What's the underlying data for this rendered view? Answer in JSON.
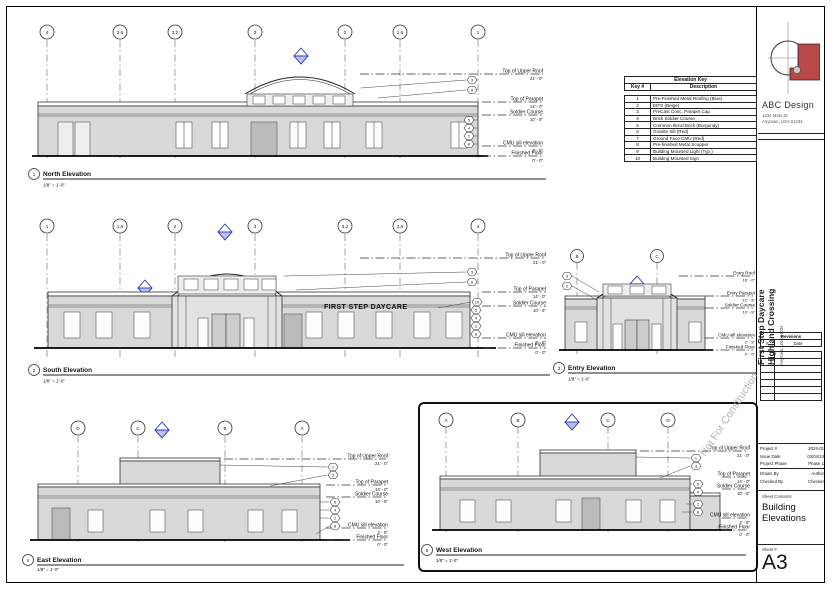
{
  "sheet": {
    "watermark": "Not For Construction",
    "firm": {
      "name": "ABC Design",
      "address1": "1234 Main St.",
      "address2": "Anytown, USA 01234"
    },
    "project": {
      "line1": "First Step Daycare",
      "line2": "Highland Crossing",
      "address": "Anytown, USA 01234"
    },
    "revisions": {
      "title": "Revisions",
      "col_no": "#",
      "col_date": "Date"
    },
    "info": {
      "project_label": "Project #",
      "project_value": "2024-01",
      "issue_label": "Issue Date",
      "issue_value": "03/04/24",
      "phase_label": "Project Phase",
      "phase_value": "Phase 1",
      "drawn_label": "Drawn By",
      "drawn_value": "Author",
      "checked_label": "Checked By",
      "checked_value": "Checker"
    },
    "contents_label": "Sheet Contents",
    "contents": "Building Elevations",
    "sheet_number_label": "Sheet #",
    "sheet_number": "A3"
  },
  "elevation_key": {
    "title": "Elevation Key",
    "col_key": "Key #",
    "col_desc": "Description",
    "rows": [
      {
        "key": "1",
        "desc": "Pre-Finished Metal Roofing (Blue)"
      },
      {
        "key": "2",
        "desc": "EIFS (Beige)"
      },
      {
        "key": "3",
        "desc": "PreCast Conc. Parapet Cap"
      },
      {
        "key": "4",
        "desc": "Brick Soldier Course"
      },
      {
        "key": "5",
        "desc": "Common Bond Brick (Burgundy)"
      },
      {
        "key": "6",
        "desc": "Granite Sill (Red)"
      },
      {
        "key": "7",
        "desc": "Ground Face CMU (Red)"
      },
      {
        "key": "8",
        "desc": "Pre-finished Metal Scupper"
      },
      {
        "key": "9",
        "desc": "Building Mounted Light (Typ.)"
      },
      {
        "key": "10",
        "desc": "Building Mounted Sign"
      }
    ]
  },
  "views": {
    "north": {
      "number": "1",
      "title": "North Elevation",
      "scale": "1/8\" = 1'-0\"",
      "grids": [
        "4",
        "3.6",
        "3.2",
        "3",
        "2",
        "1.6",
        "1"
      ],
      "levels": [
        {
          "name": "Top of Upper Roof",
          "value": "21' - 0\""
        },
        {
          "name": "Top of Parapet",
          "value": "14' - 0\""
        },
        {
          "name": "Soldier Course",
          "value": "10' - 8\""
        },
        {
          "name": "CMU sill elevation",
          "value": "2' - 8\""
        },
        {
          "name": "Finished Floor",
          "value": "0' - 0\""
        }
      ],
      "keynotes": [
        "3",
        "9",
        "5",
        "4",
        "2",
        "8"
      ]
    },
    "south": {
      "number": "2",
      "title": "South Elevation",
      "scale": "1/8\" = 1'-0\"",
      "sign": "FIRST STEP DAYCARE",
      "grids": [
        "1",
        "1.6",
        "2",
        "3",
        "3.2",
        "3.6",
        "4"
      ],
      "levels": [
        {
          "name": "Top of Upper Roof",
          "value": "21' - 0\""
        },
        {
          "name": "Top of Parapet",
          "value": "14' - 0\""
        },
        {
          "name": "Soldier Course",
          "value": "10' - 8\""
        },
        {
          "name": "CMU sill elevation",
          "value": "2' - 8\""
        },
        {
          "name": "Finished Floor",
          "value": "0' - 0\""
        }
      ],
      "keynotes": [
        "3",
        "9",
        "10",
        "5",
        "4",
        "2",
        "8"
      ]
    },
    "entry": {
      "number": "3",
      "title": "Entry Elevation",
      "scale": "1/8\" = 1'-0\"",
      "grids": [
        "B",
        "C"
      ],
      "levels": [
        {
          "name": "Entry Roof",
          "value": "16' - 0\""
        },
        {
          "name": "Entry Parapet",
          "value": "12' - 8\""
        },
        {
          "name": "Soldier Course",
          "value": "10' - 8\""
        },
        {
          "name": "CMU sill elevation",
          "value": "2' - 8\""
        },
        {
          "name": "Finished Floor",
          "value": "0' - 0\""
        }
      ],
      "keynotes": [
        "3",
        "2"
      ]
    },
    "east": {
      "number": "4",
      "title": "East Elevation",
      "scale": "1/8\" = 1'-0\"",
      "grids": [
        "D",
        "C",
        "B",
        "A"
      ],
      "levels": [
        {
          "name": "Top of Upper Roof",
          "value": "21' - 0\""
        },
        {
          "name": "Top of Parapet",
          "value": "14' - 0\""
        },
        {
          "name": "Soldier Course",
          "value": "10' - 8\""
        },
        {
          "name": "CMU sill elevation",
          "value": "2' - 8\""
        },
        {
          "name": "Finished Floor",
          "value": "0' - 0\""
        }
      ],
      "keynotes": [
        "1",
        "3",
        "5",
        "4",
        "2",
        "8"
      ]
    },
    "west": {
      "number": "5",
      "title": "West Elevation",
      "scale": "1/8\" = 1'-0\"",
      "grids": [
        "A",
        "B",
        "C",
        "D"
      ],
      "levels": [
        {
          "name": "Top of Upper Roof",
          "value": "21' - 0\""
        },
        {
          "name": "Top of Parapet",
          "value": "14' - 0\""
        },
        {
          "name": "Soldier Course",
          "value": "10' - 8\""
        },
        {
          "name": "CMU sill elevation",
          "value": "2' - 8\""
        },
        {
          "name": "Finished Floor",
          "value": "0' - 0\""
        }
      ],
      "keynotes": [
        "1",
        "3",
        "5",
        "4",
        "2",
        "8"
      ]
    }
  },
  "colors": {
    "accent_blue": "#2233bb",
    "logo_red": "#b8484a",
    "wall_gray": "#d9d9d9"
  }
}
